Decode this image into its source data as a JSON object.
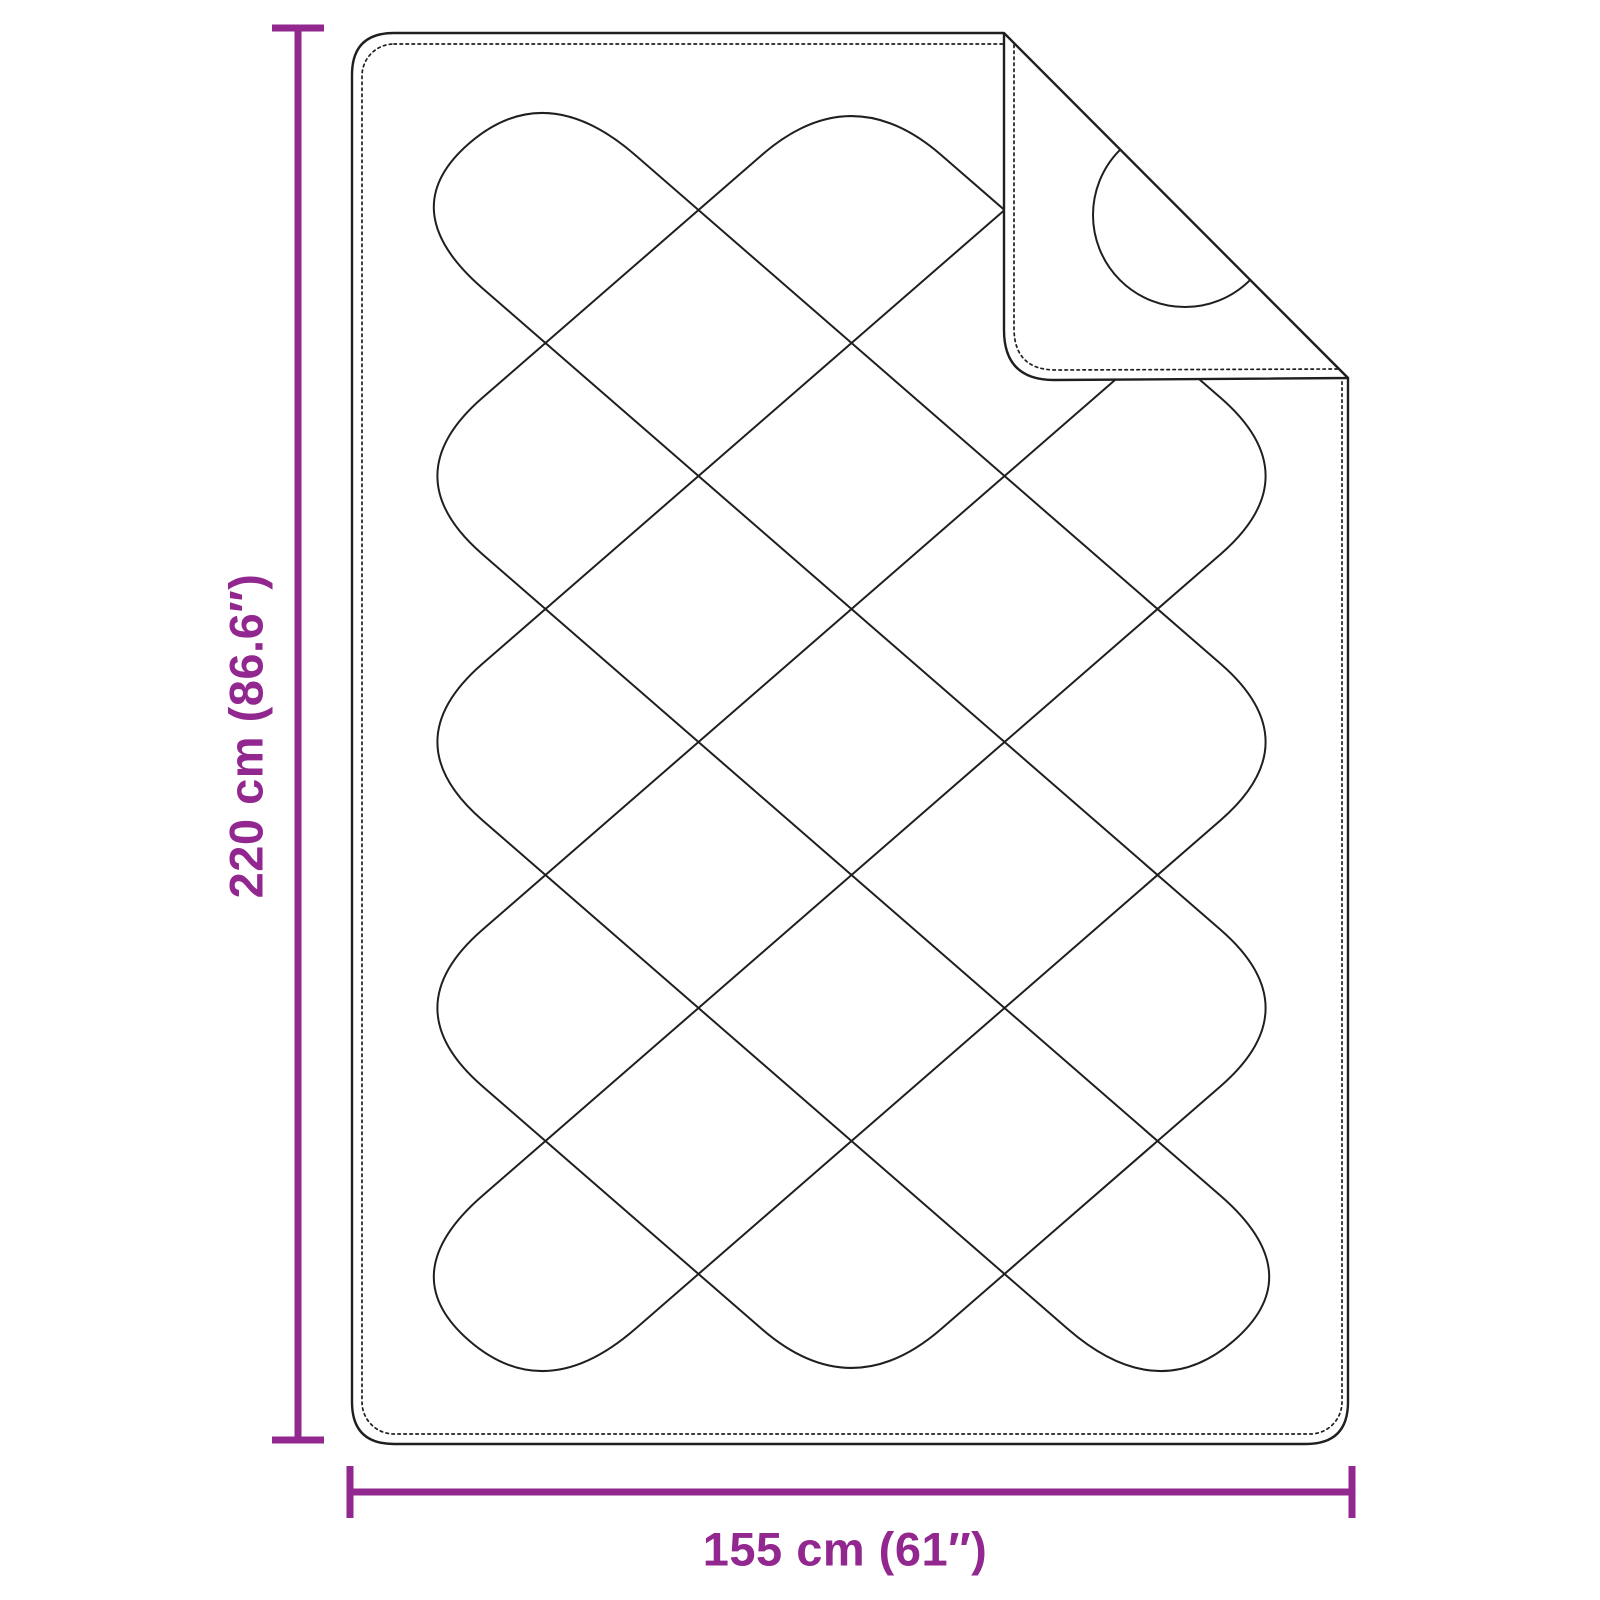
{
  "diagram": {
    "subject": "quilted blanket with folded top-right corner — product dimension diagram",
    "height_label": "220 cm (86.6″)",
    "width_label": "155 cm (61″)",
    "colors": {
      "dimension": "#92278F",
      "outline": "#1f1f1f",
      "background": "#FFFFFF"
    }
  }
}
